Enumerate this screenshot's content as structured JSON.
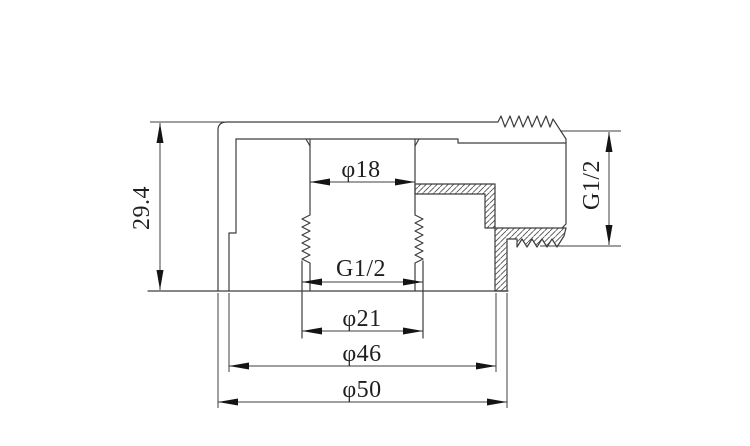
{
  "drawing": {
    "type": "technical-section-drawing",
    "part": "threaded-pipe-fitting-cross-section",
    "line_color": "#3d3d3d",
    "arrow_color": "#141414",
    "background_color": "#ffffff",
    "dimensions": {
      "overall_height": "29.4",
      "top_bore_diameter": "φ18",
      "internal_thread": "G1/2",
      "thread_major_diameter": "φ21",
      "skirt_inner_diameter": "φ46",
      "outer_diameter": "φ50",
      "side_thread": "G1/2"
    }
  }
}
